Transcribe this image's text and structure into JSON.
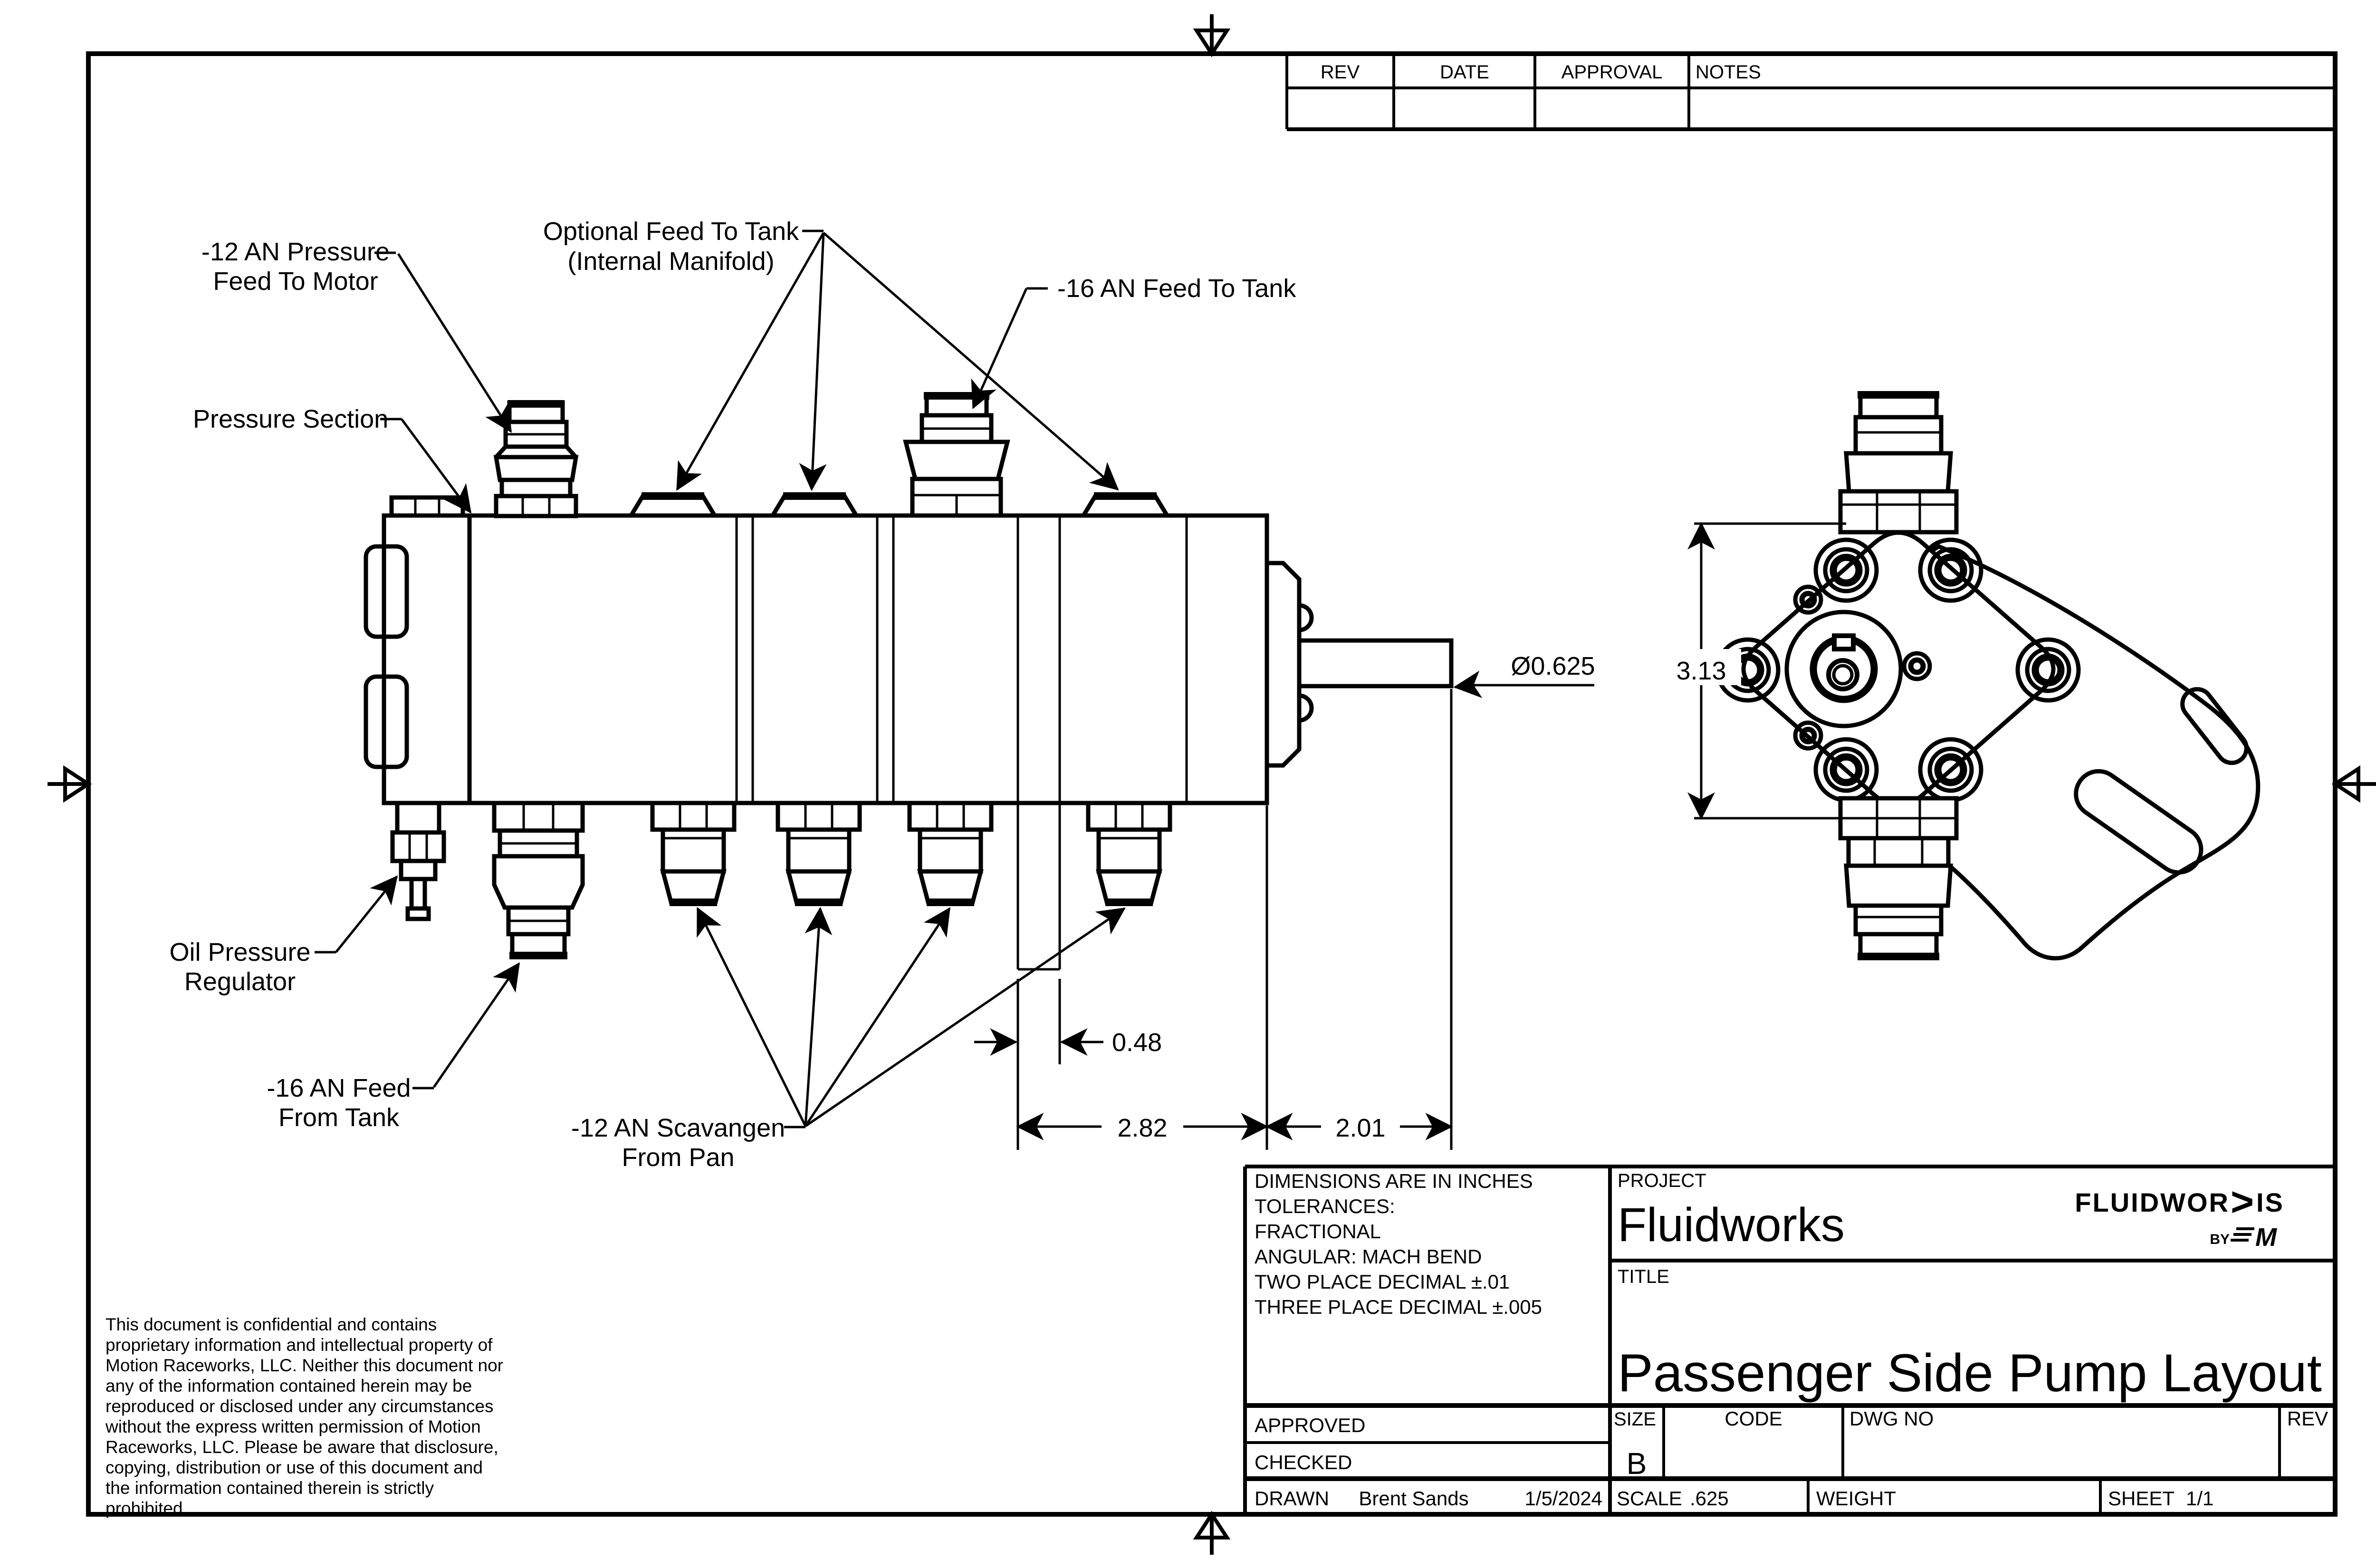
{
  "sheet": {
    "accent_red": "#e8222d"
  },
  "rev_table": {
    "rev": "REV",
    "date": "DATE",
    "approval": "APPROVAL",
    "notes": "NOTES"
  },
  "callouts": {
    "pressure_feed_line1": "-12 AN Pressure",
    "pressure_feed_line2": "Feed To Motor",
    "optional_feed_line1": "Optional Feed To Tank",
    "optional_feed_line2": "(Internal Manifold)",
    "feed_to_tank": "-16 AN Feed To Tank",
    "pressure_section": "Pressure Section",
    "oil_regulator_line1": "Oil Pressure",
    "oil_regulator_line2": "Regulator",
    "feed_from_tank_line1": "-16 AN Feed",
    "feed_from_tank_line2": "From Tank",
    "scavenge_line1": "-12 AN Scavangen",
    "scavenge_line2": "From Pan"
  },
  "dimensions": {
    "shaft_diameter": "Ø0.625",
    "pump_height": "3.13",
    "plate_width": "0.48",
    "body_length": "2.82",
    "shaft_length": "2.01"
  },
  "tolerances": {
    "line1": "DIMENSIONS ARE IN INCHES",
    "line2": "TOLERANCES:",
    "line3": "FRACTIONAL",
    "line4": "ANGULAR: MACH BEND",
    "line5": "TWO PLACE DECIMAL ±.01",
    "line6": "THREE PLACE DECIMAL ±.005"
  },
  "title_block": {
    "project_label": "PROJECT",
    "project": "Fluidworks",
    "title_label": "TITLE",
    "title": "Passenger Side Pump Layout",
    "approved_label": "APPROVED",
    "checked_label": "CHECKED",
    "drawn_label": "DRAWN",
    "drawn_by": "Brent Sands",
    "drawn_date": "1/5/2024",
    "size_label": "SIZE",
    "size": "B",
    "code_label": "CODE",
    "dwg_label": "DWG NO",
    "rev_label": "REV",
    "scale_label": "SCALE",
    "scale": ".625",
    "weight_label": "WEIGHT",
    "sheet_label": "SHEET",
    "sheet": "1/1"
  },
  "logo": {
    "brand_start": "FLUIDWOR",
    "brand_chevron": ">",
    "brand_end": "IS",
    "by": "BY",
    "mark": "M"
  },
  "confidential": {
    "line1": "This document is confidential and contains",
    "line2": "proprietary information and intellectual property of",
    "line3": "Motion Raceworks, LLC. Neither this document nor",
    "line4": "any of the information contained herein may be",
    "line5": "reproduced or disclosed under any circumstances",
    "line6": "without the express written permission of Motion",
    "line7": "Raceworks, LLC. Please be aware that disclosure,",
    "line8": "copying, distribution or use of this document and",
    "line9": "the information contained therein is strictly",
    "line10": "prohibited."
  }
}
